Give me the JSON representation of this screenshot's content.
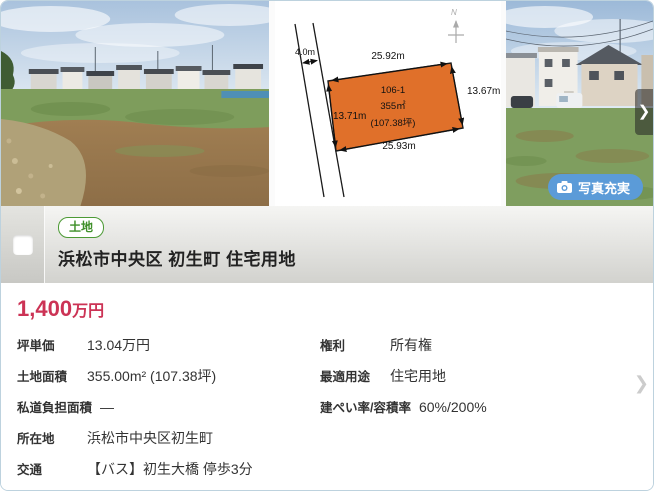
{
  "photo_section": {
    "next_button_icon": "❯",
    "photo_badge_label": "写真充実",
    "badge_color": "#5b9bd8",
    "diagram": {
      "north_label": "N",
      "road_width": "4.0m",
      "lot_number": "106-1",
      "lot_area": "355㎡",
      "lot_area_tsubo": "(107.38坪)",
      "dim_top": "25.92m",
      "dim_right": "13.67m",
      "dim_left": "13.71m",
      "dim_bottom": "25.93m",
      "lot_fill_color": "#e0702a"
    }
  },
  "header": {
    "type_badge": "土地",
    "title": "浜松市中央区 初生町 住宅用地",
    "badge_color": "#4c9a35"
  },
  "price": {
    "amount": "1,400",
    "unit": "万円",
    "color": "#cc3355"
  },
  "details": {
    "chevron_icon": "❯",
    "left": [
      {
        "label": "坪単価",
        "value": "13.04万円"
      },
      {
        "label": "土地面積",
        "value": "355.00m² (107.38坪)"
      },
      {
        "label": "私道負担面積",
        "value": "―"
      },
      {
        "label": "所在地",
        "value": "浜松市中央区初生町"
      },
      {
        "label": "交通",
        "value": "【バス】初生大橋 停歩3分"
      }
    ],
    "right": [
      {
        "label": "権利",
        "value": "所有権"
      },
      {
        "label": "最適用途",
        "value": "住宅用地"
      },
      {
        "label": "建ぺい率/容積率",
        "value": "60%/200%"
      }
    ]
  }
}
